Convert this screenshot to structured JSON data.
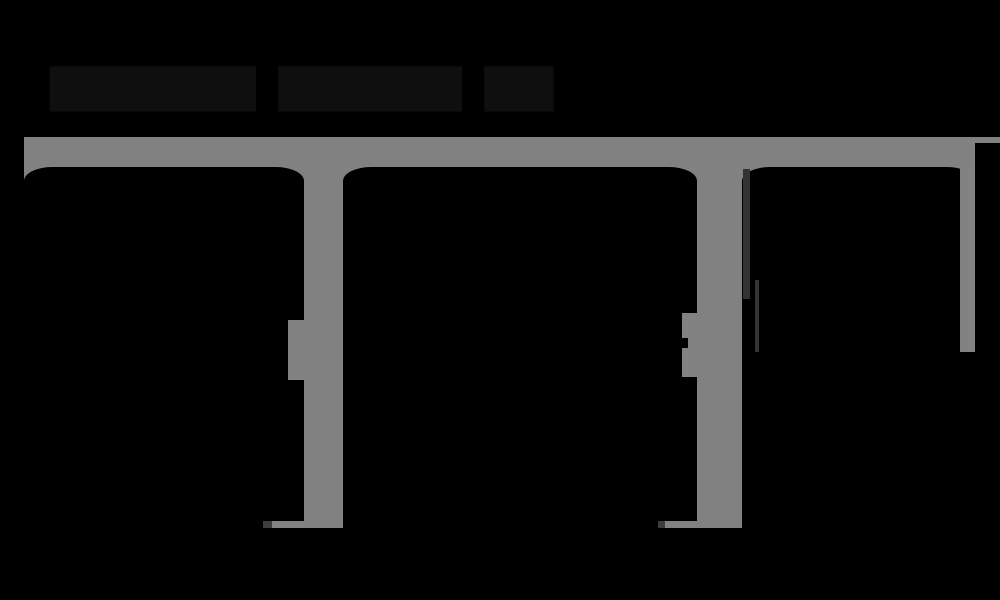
{
  "page": {
    "background_color": "#000000",
    "title_text": "█████████ ████████ ███",
    "title_note": "illegible-dark-heading",
    "title_color": "#0f0f0f"
  },
  "chrome": {
    "color": "#818181",
    "top_bar": {
      "x": 24,
      "y": 137,
      "width": 976,
      "height": 30
    },
    "container_bottom_y": 528
  },
  "panels": [
    {
      "id": "panel-1",
      "x": 24,
      "y": 167,
      "width": 280,
      "height": 361,
      "background": "#000000",
      "vertical_scrollbar_thumb": {
        "top": 320,
        "height": 60,
        "color": "#828282"
      },
      "horizontal_scrollbar_thumb": {
        "width": 32,
        "color": "#828282",
        "lead_color": "#3d3d3d"
      }
    },
    {
      "id": "panel-2",
      "x": 343,
      "y": 167,
      "width": 354,
      "height": 361,
      "background": "#000000",
      "vertical_scrollbar_thumb": {
        "top": 313,
        "height": 64,
        "color": "#828282"
      },
      "horizontal_scrollbar_thumb": {
        "width": 32,
        "color": "#828282",
        "lead_color": "#3d3d3d"
      }
    },
    {
      "id": "panel-3",
      "x": 742,
      "y": 167,
      "width": 233,
      "height": 361,
      "background": "#000000",
      "vertical_scrollbar_thumb": {
        "top": 167,
        "height": 185,
        "color": "#828282"
      },
      "edge_lines_color": "#333333"
    }
  ],
  "gutters": [
    {
      "id": "gutter-1",
      "x": 304,
      "width": 39,
      "color": "#818181"
    },
    {
      "id": "gutter-2",
      "x": 697,
      "width": 45,
      "color": "#818181"
    }
  ]
}
